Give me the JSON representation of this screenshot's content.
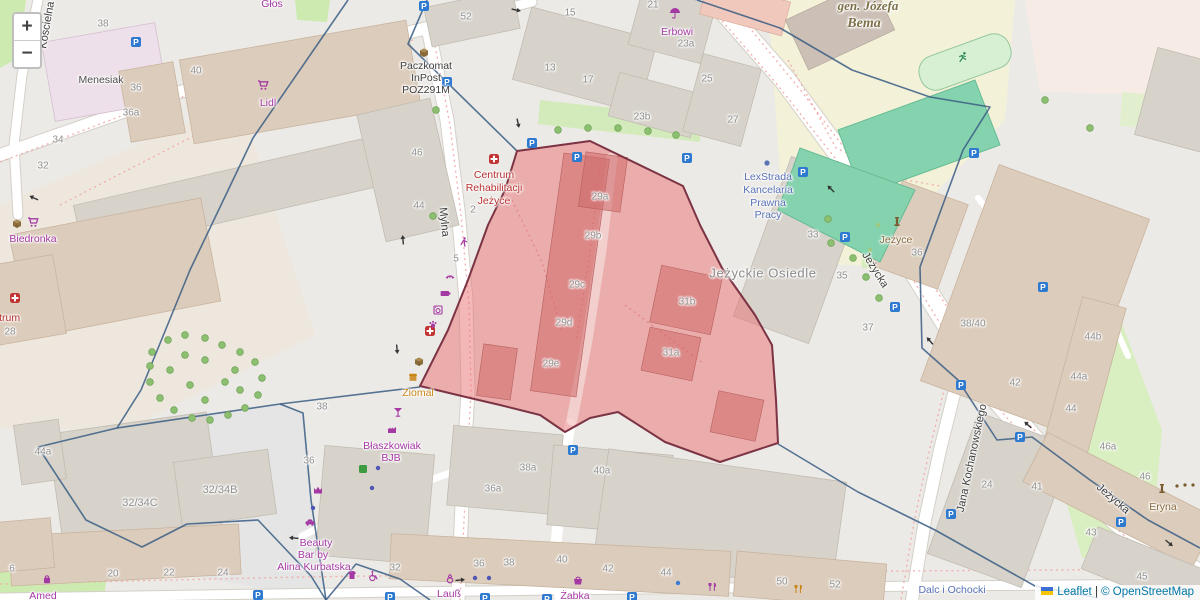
{
  "controls": {
    "zoom_in": "+",
    "zoom_out": "−"
  },
  "attribution": {
    "leaflet": "Leaflet",
    "separator": "|",
    "copyright": "© OpenStreetMap"
  },
  "colors": {
    "highlight_fill": "#e87070",
    "highlight_border": "#7c3344",
    "boundary_line": "#3a5d84",
    "shop_label": "#a439a4",
    "health_label": "#b93232",
    "office_label": "#5872b5",
    "street_label": "#3d3d3d",
    "housenumber": "#8f8f8f",
    "parking_blue": "#2e7ad1"
  },
  "map": {
    "highlight": {
      "points": "590,141 683,186 700,225 722,268 755,315 772,345 776,400 778,443 720,462 665,442 618,412 590,418 565,432 540,415 500,405 470,398 420,386 448,330 468,280 488,225 505,190 517,151"
    },
    "boundaries": [
      "427,0 408,44 517,151",
      "348,0 253,138 190,270 141,390 117,428 38,447",
      "420,387 280,404 117,428",
      "38,447 86,520 142,547 187,524 258,520 311,576 326,600",
      "280,404 303,413 311,500 326,600",
      "326,600 356,564 400,579 430,600",
      "697,0 780,28 852,70 930,97 990,107 963,150 920,267 922,348 958,380 997,440 1032,437 1090,480 1148,520 1200,548",
      "778,444 858,492 935,530 1035,586 1098,598"
    ],
    "labels": [
      {
        "t": "Głos",
        "x": 272,
        "y": 4,
        "c": "shop"
      },
      {
        "t": "38",
        "x": 103,
        "y": 24,
        "c": "num"
      },
      {
        "t": "40",
        "x": 196,
        "y": 71,
        "c": "num"
      },
      {
        "t": "36",
        "x": 136,
        "y": 88,
        "c": "num"
      },
      {
        "t": "36a",
        "x": 131,
        "y": 113,
        "c": "num"
      },
      {
        "t": "34",
        "x": 58,
        "y": 140,
        "c": "num"
      },
      {
        "t": "32",
        "x": 43,
        "y": 166,
        "c": "num"
      },
      {
        "t": "Menesiak",
        "x": 101,
        "y": 80,
        "c": "name",
        "n": "building-name-menesiak"
      },
      {
        "t": "Lidl",
        "x": 268,
        "y": 103,
        "c": "shop",
        "n": "poi-lidl"
      },
      {
        "t": "Paczkomat",
        "x": 426,
        "y": 66,
        "c": "poi",
        "n": "poi-paczkomat"
      },
      {
        "t": "InPost",
        "x": 426,
        "y": 78,
        "c": "poi"
      },
      {
        "t": "POZ291M",
        "x": 426,
        "y": 90,
        "c": "poi"
      },
      {
        "t": "52",
        "x": 466,
        "y": 17,
        "c": "num"
      },
      {
        "t": "13",
        "x": 550,
        "y": 68,
        "c": "num"
      },
      {
        "t": "17",
        "x": 588,
        "y": 80,
        "c": "num"
      },
      {
        "t": "15",
        "x": 570,
        "y": 13,
        "c": "num"
      },
      {
        "t": "21",
        "x": 653,
        "y": 5,
        "c": "num"
      },
      {
        "t": "23a",
        "x": 686,
        "y": 44,
        "c": "num"
      },
      {
        "t": "Erbowi",
        "x": 677,
        "y": 32,
        "c": "shop",
        "n": "poi-erbowi"
      },
      {
        "t": "23b",
        "x": 642,
        "y": 117,
        "c": "num"
      },
      {
        "t": "25",
        "x": 707,
        "y": 79,
        "c": "num"
      },
      {
        "t": "27",
        "x": 733,
        "y": 120,
        "c": "num"
      },
      {
        "t": "gen. Józefa",
        "x": 868,
        "y": 6,
        "c": "olive",
        "n": "school-name"
      },
      {
        "t": "Bema",
        "x": 864,
        "y": 24,
        "c": "olive",
        "fs": 14
      },
      {
        "t": "Kościelna",
        "x": 47,
        "y": 25,
        "c": "street",
        "r": -80,
        "n": "street-koscielna"
      },
      {
        "t": "Biedronka",
        "x": 33,
        "y": 239,
        "c": "shop",
        "n": "poi-biedronka"
      },
      {
        "t": "Centrum",
        "x": 0,
        "y": 318,
        "c": "health"
      },
      {
        "t": "28",
        "x": 10,
        "y": 332,
        "c": "num"
      },
      {
        "t": "46",
        "x": 417,
        "y": 153,
        "c": "num"
      },
      {
        "t": "44",
        "x": 419,
        "y": 206,
        "c": "num"
      },
      {
        "t": "2",
        "x": 473,
        "y": 210,
        "c": "num"
      },
      {
        "t": "5",
        "x": 456,
        "y": 259,
        "c": "num"
      },
      {
        "t": "Mylna",
        "x": 444,
        "y": 222,
        "c": "street",
        "r": 84,
        "n": "street-mylna"
      },
      {
        "t": "Centrum",
        "x": 494,
        "y": 175,
        "c": "health",
        "n": "poi-centrum-rehabilitacji"
      },
      {
        "t": "Rehabilitacji",
        "x": 494,
        "y": 188,
        "c": "health"
      },
      {
        "t": "Jeżyce",
        "x": 494,
        "y": 201,
        "c": "health"
      },
      {
        "t": "29a",
        "x": 600,
        "y": 197,
        "c": "num"
      },
      {
        "t": "29b",
        "x": 593,
        "y": 236,
        "c": "num"
      },
      {
        "t": "29c",
        "x": 577,
        "y": 285,
        "c": "num"
      },
      {
        "t": "29d",
        "x": 564,
        "y": 323,
        "c": "num"
      },
      {
        "t": "29e",
        "x": 551,
        "y": 364,
        "c": "num"
      },
      {
        "t": "31b",
        "x": 687,
        "y": 302,
        "c": "num"
      },
      {
        "t": "31a",
        "x": 671,
        "y": 353,
        "c": "num"
      },
      {
        "t": "LexStrada",
        "x": 768,
        "y": 177,
        "c": "office",
        "n": "poi-lexstrada"
      },
      {
        "t": "Kancelaria",
        "x": 768,
        "y": 190,
        "c": "office"
      },
      {
        "t": "Prawna",
        "x": 768,
        "y": 203,
        "c": "office"
      },
      {
        "t": "Pracy",
        "x": 768,
        "y": 215,
        "c": "office"
      },
      {
        "t": "Jeżyckie Osiedle",
        "x": 763,
        "y": 273,
        "c": "place",
        "n": "place-jezyckie-osiedle"
      },
      {
        "t": "33",
        "x": 813,
        "y": 235,
        "c": "num"
      },
      {
        "t": "35",
        "x": 842,
        "y": 276,
        "c": "num"
      },
      {
        "t": "37",
        "x": 868,
        "y": 328,
        "c": "num"
      },
      {
        "t": "Jeżycka",
        "x": 875,
        "y": 270,
        "c": "street",
        "r": 58,
        "n": "street-jezycka-upper"
      },
      {
        "t": "Jeżyce",
        "x": 896,
        "y": 240,
        "c": "brown",
        "n": "poi-jezyce-monument"
      },
      {
        "t": "36",
        "x": 917,
        "y": 253,
        "c": "num"
      },
      {
        "t": "38/40",
        "x": 973,
        "y": 324,
        "c": "num"
      },
      {
        "t": "42",
        "x": 1015,
        "y": 383,
        "c": "num"
      },
      {
        "t": "44b",
        "x": 1093,
        "y": 337,
        "c": "num"
      },
      {
        "t": "44a",
        "x": 1079,
        "y": 377,
        "c": "num"
      },
      {
        "t": "44",
        "x": 1071,
        "y": 409,
        "c": "num"
      },
      {
        "t": "46a",
        "x": 1108,
        "y": 447,
        "c": "num"
      },
      {
        "t": "46",
        "x": 1145,
        "y": 477,
        "c": "num"
      },
      {
        "t": "Eryna",
        "x": 1163,
        "y": 507,
        "c": "brown",
        "n": "poi-eryna"
      },
      {
        "t": "Jeżycka",
        "x": 1113,
        "y": 499,
        "c": "street",
        "r": 41,
        "n": "street-jezycka-lower"
      },
      {
        "t": "Jana Kochanowskiego",
        "x": 972,
        "y": 458,
        "c": "street",
        "r": -78,
        "n": "street-jana-kochanowskiego"
      },
      {
        "t": "24",
        "x": 987,
        "y": 485,
        "c": "num"
      },
      {
        "t": "41",
        "x": 1037,
        "y": 487,
        "c": "num"
      },
      {
        "t": "43",
        "x": 1091,
        "y": 533,
        "c": "num"
      },
      {
        "t": "45",
        "x": 1142,
        "y": 577,
        "c": "num"
      },
      {
        "t": "Dalc i Ochocki",
        "x": 952,
        "y": 590,
        "c": "office",
        "n": "poi-dalc-i-ochocki"
      },
      {
        "t": "Ziomal",
        "x": 418,
        "y": 393,
        "c": "orange",
        "n": "poi-ziomal"
      },
      {
        "t": "38",
        "x": 322,
        "y": 407,
        "c": "num"
      },
      {
        "t": "36",
        "x": 309,
        "y": 461,
        "c": "num"
      },
      {
        "t": "Błaszkowiak",
        "x": 392,
        "y": 446,
        "c": "shop",
        "n": "poi-blaszkowiak"
      },
      {
        "t": "BJB",
        "x": 391,
        "y": 458,
        "c": "shop"
      },
      {
        "t": "32/34C",
        "x": 140,
        "y": 503,
        "c": "num",
        "fs": 11
      },
      {
        "t": "32/34B",
        "x": 220,
        "y": 490,
        "c": "num",
        "fs": 11
      },
      {
        "t": "44a",
        "x": 43,
        "y": 452,
        "c": "num"
      },
      {
        "t": "Beauty",
        "x": 316,
        "y": 543,
        "c": "shop",
        "n": "poi-beauty-bar"
      },
      {
        "t": "Bar by",
        "x": 313,
        "y": 555,
        "c": "shop"
      },
      {
        "t": "Alina Kurbatska",
        "x": 314,
        "y": 567,
        "c": "shop"
      },
      {
        "t": "6",
        "x": 12,
        "y": 569,
        "c": "num"
      },
      {
        "t": "20",
        "x": 113,
        "y": 574,
        "c": "num"
      },
      {
        "t": "22",
        "x": 169,
        "y": 573,
        "c": "num"
      },
      {
        "t": "24",
        "x": 223,
        "y": 573,
        "c": "num"
      },
      {
        "t": "Amed",
        "x": 43,
        "y": 596,
        "c": "shop",
        "n": "poi-amed"
      },
      {
        "t": "32",
        "x": 395,
        "y": 568,
        "c": "num"
      },
      {
        "t": "36a",
        "x": 493,
        "y": 489,
        "c": "num"
      },
      {
        "t": "38a",
        "x": 528,
        "y": 468,
        "c": "num"
      },
      {
        "t": "40a",
        "x": 602,
        "y": 471,
        "c": "num"
      },
      {
        "t": "36",
        "x": 479,
        "y": 564,
        "c": "num"
      },
      {
        "t": "38",
        "x": 509,
        "y": 563,
        "c": "num"
      },
      {
        "t": "40",
        "x": 562,
        "y": 560,
        "c": "num"
      },
      {
        "t": "42",
        "x": 608,
        "y": 569,
        "c": "num"
      },
      {
        "t": "44",
        "x": 666,
        "y": 573,
        "c": "num"
      },
      {
        "t": "Lauß",
        "x": 449,
        "y": 594,
        "c": "shop",
        "n": "poi-laus"
      },
      {
        "t": "Żabka",
        "x": 575,
        "y": 596,
        "c": "shop",
        "n": "poi-zabka"
      },
      {
        "t": "50",
        "x": 782,
        "y": 582,
        "c": "num"
      },
      {
        "t": "52",
        "x": 835,
        "y": 585,
        "c": "num"
      }
    ],
    "markers": [
      [
        "parking",
        424,
        6
      ],
      [
        "parking",
        136,
        42
      ],
      [
        "parking",
        447,
        82
      ],
      [
        "parking",
        532,
        143
      ],
      [
        "parking",
        577,
        157
      ],
      [
        "parking",
        687,
        158
      ],
      [
        "parking",
        974,
        153
      ],
      [
        "parking",
        803,
        172
      ],
      [
        "parking",
        845,
        237
      ],
      [
        "parking",
        895,
        307
      ],
      [
        "parking",
        1043,
        287
      ],
      [
        "parking",
        961,
        385
      ],
      [
        "parking",
        1020,
        437
      ],
      [
        "parking",
        1121,
        522
      ],
      [
        "parking",
        951,
        514
      ],
      [
        "parking",
        573,
        450
      ],
      [
        "parking",
        258,
        595
      ],
      [
        "parking",
        390,
        597
      ],
      [
        "parking",
        485,
        598
      ],
      [
        "parking",
        547,
        599
      ],
      [
        "parking",
        632,
        597
      ],
      [
        "medical",
        494,
        159
      ],
      [
        "medical",
        15,
        298
      ],
      [
        "medical",
        430,
        331
      ],
      [
        "package",
        424,
        52
      ],
      [
        "package",
        17,
        223
      ],
      [
        "package",
        419,
        361
      ],
      [
        "cart",
        263,
        85
      ],
      [
        "cart",
        33,
        222
      ],
      [
        "umbrella",
        675,
        13
      ],
      [
        "monument",
        897,
        222
      ],
      [
        "monument",
        1162,
        489
      ],
      [
        "runner",
        963,
        57
      ],
      [
        "basket",
        578,
        580
      ],
      [
        "cocktail",
        398,
        412
      ],
      [
        "factory",
        392,
        429
      ],
      [
        "dot-indigo",
        378,
        468
      ],
      [
        "dot-indigo",
        372,
        488
      ],
      [
        "dot-indigo",
        313,
        508
      ],
      [
        "dot-indigo",
        475,
        578
      ],
      [
        "dot-indigo",
        489,
        578
      ],
      [
        "square-green",
        363,
        469
      ],
      [
        "dancer",
        463,
        242
      ],
      [
        "lashes",
        450,
        277
      ],
      [
        "battery",
        445,
        293
      ],
      [
        "washer",
        438,
        310
      ],
      [
        "paw",
        433,
        324
      ],
      [
        "crown",
        318,
        490
      ],
      [
        "car",
        310,
        522
      ],
      [
        "clothes",
        352,
        575
      ],
      [
        "wheelchair",
        373,
        576
      ],
      [
        "ring",
        450,
        579
      ],
      [
        "restaurant",
        712,
        587
      ],
      [
        "cutlery-orange",
        798,
        589
      ],
      [
        "shop-orange",
        413,
        377
      ],
      [
        "bag",
        47,
        579
      ],
      [
        "dot-blue",
        678,
        583
      ],
      [
        "dot-office",
        767,
        163
      ],
      [
        "dot-brown",
        1177,
        486
      ],
      [
        "dot-brown",
        1185,
        485
      ],
      [
        "dot-brown",
        1193,
        485
      ],
      [
        "arrow",
        516,
        10,
        12
      ],
      [
        "arrow",
        518,
        123,
        78
      ],
      [
        "arrow",
        831,
        189,
        225
      ],
      [
        "arrow",
        930,
        341,
        228
      ],
      [
        "arrow",
        1028,
        425,
        222
      ],
      [
        "arrow",
        403,
        240,
        265
      ],
      [
        "arrow",
        397,
        349,
        85
      ],
      [
        "arrow",
        34,
        198,
        205
      ],
      [
        "arrow",
        1169,
        543,
        40
      ],
      [
        "arrow",
        294,
        538,
        185
      ],
      [
        "arrow",
        460,
        580,
        355
      ],
      [
        "tree",
        828,
        219
      ],
      [
        "tree",
        831,
        243
      ],
      [
        "tree",
        853,
        258
      ],
      [
        "tree",
        866,
        277
      ],
      [
        "tree",
        879,
        298
      ],
      [
        "tree",
        433,
        216
      ],
      [
        "tree",
        436,
        110
      ],
      [
        "tree",
        1045,
        100
      ],
      [
        "tree",
        1090,
        128
      ],
      [
        "tree",
        558,
        130
      ],
      [
        "tree",
        588,
        128
      ],
      [
        "tree",
        618,
        128
      ],
      [
        "tree",
        648,
        131
      ],
      [
        "tree",
        676,
        135
      ],
      [
        "bush",
        878,
        225
      ],
      [
        "bush",
        900,
        240
      ],
      [
        "bush",
        915,
        255
      ],
      [
        "bush",
        870,
        250
      ],
      [
        "tree",
        152,
        352
      ],
      [
        "tree",
        168,
        340
      ],
      [
        "tree",
        185,
        335
      ],
      [
        "tree",
        205,
        338
      ],
      [
        "tree",
        222,
        345
      ],
      [
        "tree",
        240,
        352
      ],
      [
        "tree",
        255,
        362
      ],
      [
        "tree",
        262,
        378
      ],
      [
        "tree",
        258,
        395
      ],
      [
        "tree",
        245,
        408
      ],
      [
        "tree",
        228,
        415
      ],
      [
        "tree",
        210,
        420
      ],
      [
        "tree",
        192,
        418
      ],
      [
        "tree",
        174,
        410
      ],
      [
        "tree",
        160,
        398
      ],
      [
        "tree",
        150,
        382
      ],
      [
        "tree",
        150,
        366
      ],
      [
        "tree",
        205,
        360
      ],
      [
        "tree",
        225,
        382
      ],
      [
        "tree",
        190,
        385
      ],
      [
        "tree",
        170,
        370
      ],
      [
        "tree",
        240,
        390
      ],
      [
        "tree",
        205,
        400
      ],
      [
        "tree",
        235,
        370
      ],
      [
        "tree",
        185,
        355
      ]
    ]
  }
}
